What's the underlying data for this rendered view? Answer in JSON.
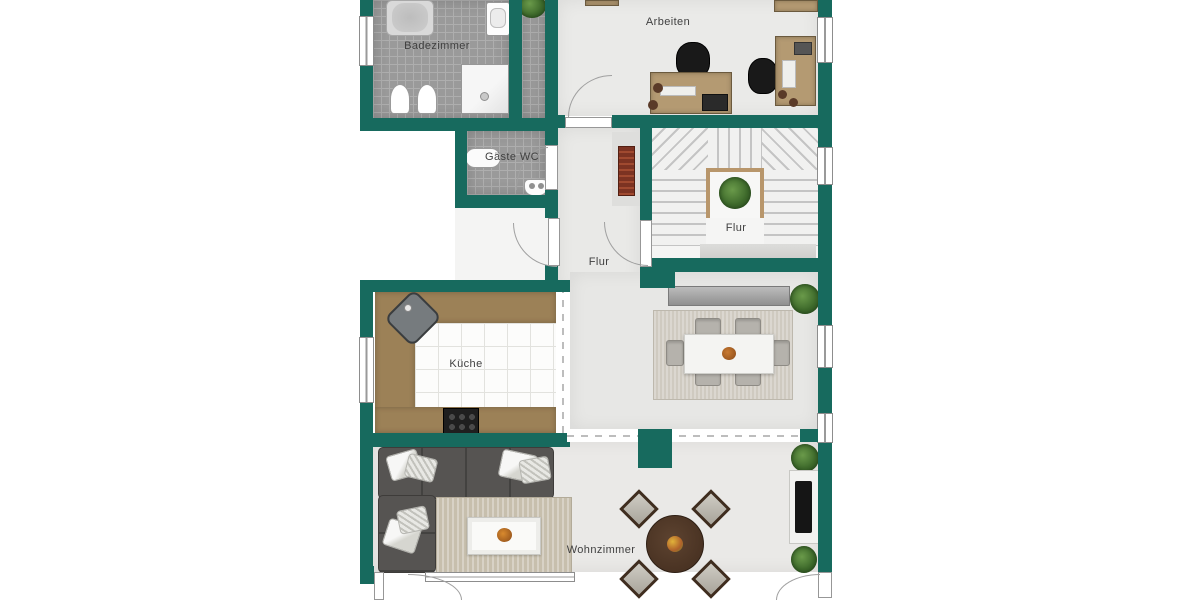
{
  "floorplan": {
    "rooms": [
      {
        "id": "badezimmer",
        "label": "Badezimmer"
      },
      {
        "id": "arbeiten",
        "label": "Arbeiten"
      },
      {
        "id": "gaeste-wc",
        "label": "Gäste WC"
      },
      {
        "id": "flur-treppe",
        "label": "Flur"
      },
      {
        "id": "flur",
        "label": "Flur"
      },
      {
        "id": "kueche",
        "label": "Küche"
      },
      {
        "id": "wohnzimmer",
        "label": "Wohnzimmer"
      }
    ],
    "colors": {
      "wall": "#176a5e",
      "floor": "#e9e9e7",
      "tile": "#9a9a9a",
      "tile_line": "#aeaeae",
      "wood": "#9c8157",
      "desk_wood": "#b49a72",
      "sofa": "#565452",
      "rug_living": "#c7bfad",
      "rug_dining": "#cfcac0",
      "table_dark": "#4a3323",
      "radiator": "#7c3322",
      "plant": "#3f6b2c",
      "label_text": "#3f3f3f",
      "stair_tread": "#f1f1f0",
      "stair_line": "#c4c4c4"
    },
    "fixtures": [
      "bathtub",
      "shower",
      "washbasin",
      "toilet",
      "bidet",
      "guest-wc-sink",
      "guest-wc-toilet",
      "desk",
      "office-chair",
      "staircase",
      "plant",
      "radiator",
      "kitchen-counter",
      "kitchen-corner-sink",
      "stove",
      "dining-table",
      "dining-chair",
      "sideboard",
      "sofa",
      "cushion",
      "coffee-table",
      "round-table",
      "chair",
      "tv-lowboard",
      "tv",
      "window",
      "door"
    ]
  }
}
